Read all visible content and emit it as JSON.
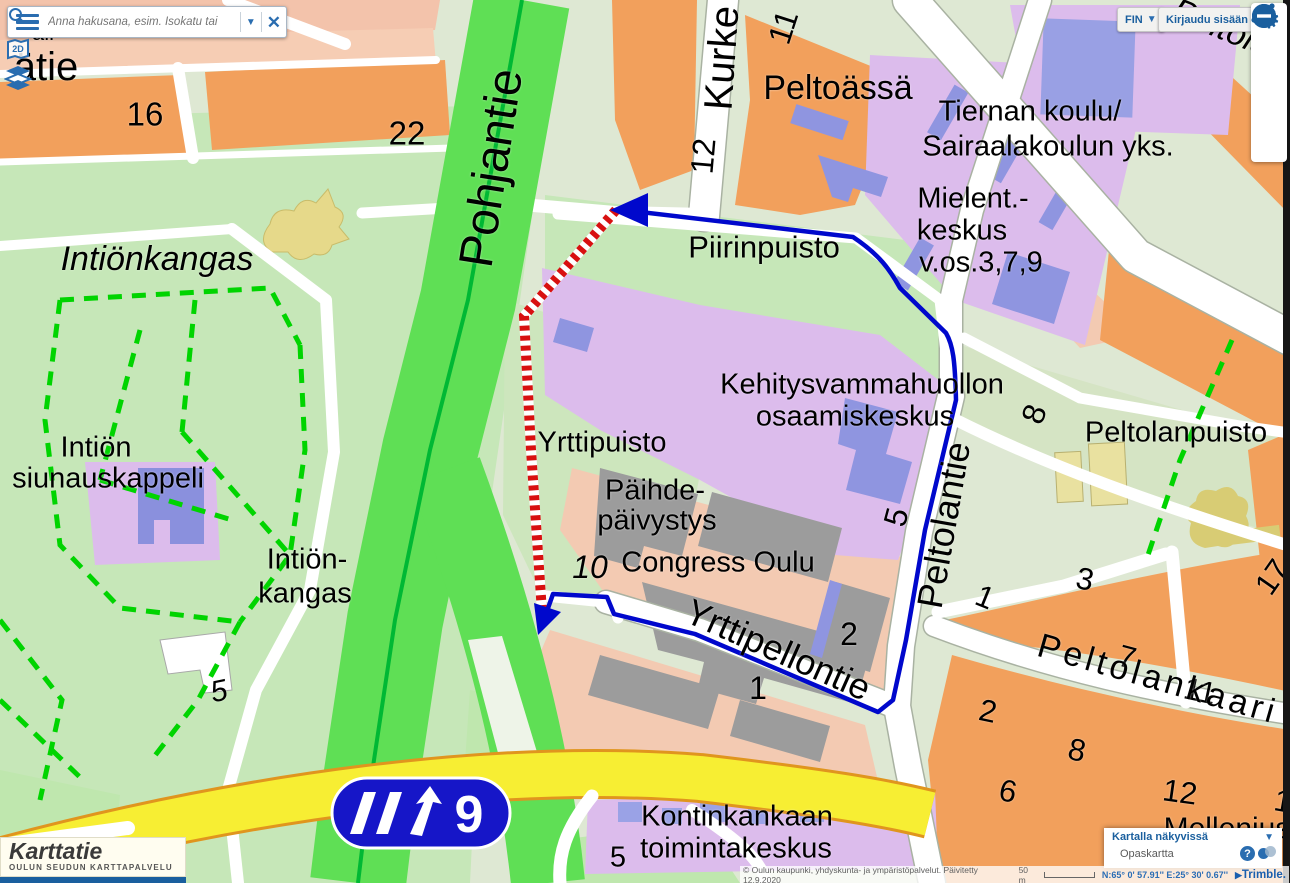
{
  "search": {
    "placeholder": "Anna hakusana, esim. Isokatu tai",
    "close_glyph": "✕",
    "caret_glyph": "▼"
  },
  "top_buttons": {
    "language": "FIN",
    "language_caret": "▼",
    "login": "Kirjaudu sisään"
  },
  "toolbar": {
    "tools": [
      "settings",
      "measure-route",
      "locate",
      "zoom-in",
      "zoom-out"
    ],
    "gear_glyph": "⚙",
    "zoom_in_glyph": "+",
    "zoom_out_glyph": "−"
  },
  "side_icons": {
    "map_2d_label": "2D"
  },
  "layers_panel": {
    "title": "Kartalla näkyvissä",
    "caret_glyph": "▼",
    "layer_name": "Opaskartta",
    "help_glyph": "?"
  },
  "statusbar": {
    "attribution": "© Oulun kaupunki, yhdyskunta- ja ympäristöpalvelut. Päivitetty 12.9.2020",
    "scale": "50 m",
    "coordinates": "N:65° 0' 57.91'' E:25° 30' 0.67''",
    "brand_triangle": "▶",
    "brand": "Trimble."
  },
  "logo": {
    "title": "Karttatie",
    "subtitle": "OULUN SEUDUN KARTTAPALVELU"
  },
  "highway_sign": {
    "number": "9"
  },
  "colors": {
    "route_blue": "#0008cc",
    "highway_green": "#5fdf55",
    "road_yellow": "#f7ee33",
    "area_orange": "#f2a05c",
    "area_purple": "#dcbcec",
    "area_pink": "#f6cdb4",
    "park_green": "#c6e7b8",
    "building_blue": "#8f95e0",
    "building_gray": "#9c9c9c",
    "path_dashed_green": "#00d400",
    "railway_red": "#d81010",
    "ui_blue": "#1a5f9e",
    "sign_blue": "#1616c8"
  },
  "map": {
    "labels": [
      {
        "t": "Pohjantie",
        "x": 492,
        "y": 168,
        "s": 48,
        "r": -81
      },
      {
        "t": "Kurke",
        "x": 722,
        "y": 58,
        "s": 40,
        "r": -86
      },
      {
        "t": "11",
        "x": 783,
        "y": 27,
        "s": 32,
        "r": -72
      },
      {
        "t": "12",
        "x": 703,
        "y": 156,
        "s": 32,
        "r": -85
      },
      {
        "t": "Peltoässä",
        "x": 838,
        "y": 88,
        "s": 34,
        "r": 0
      },
      {
        "t": "Tiernan koulu/",
        "x": 1030,
        "y": 112,
        "s": 29,
        "r": 0
      },
      {
        "t": "Sairaalakoulun yks.",
        "x": 1048,
        "y": 147,
        "s": 29,
        "r": 0
      },
      {
        "t": "Mielent.-",
        "x": 973,
        "y": 199,
        "s": 29,
        "r": 0
      },
      {
        "t": "keskus",
        "x": 962,
        "y": 231,
        "s": 29,
        "r": 0
      },
      {
        "t": "v.os.3,7,9",
        "x": 981,
        "y": 263,
        "s": 29,
        "r": 0
      },
      {
        "t": "Piirinpuisto",
        "x": 764,
        "y": 247,
        "s": 31,
        "r": 0
      },
      {
        "t": "Kehitysvammahuollon",
        "x": 862,
        "y": 385,
        "s": 29,
        "r": 0
      },
      {
        "t": "osaamiskeskus",
        "x": 855,
        "y": 417,
        "s": 29,
        "r": 0
      },
      {
        "t": "Yrttipuisto",
        "x": 602,
        "y": 443,
        "s": 29,
        "r": 0
      },
      {
        "t": "Päihde-",
        "x": 655,
        "y": 491,
        "s": 29,
        "r": 0
      },
      {
        "t": "päivystys",
        "x": 657,
        "y": 521,
        "s": 29,
        "r": 0
      },
      {
        "t": "10",
        "x": 590,
        "y": 567,
        "s": 32,
        "r": 0,
        "i": 1
      },
      {
        "t": "Congress Oulu",
        "x": 718,
        "y": 563,
        "s": 29,
        "r": 0
      },
      {
        "t": "Yrttipellontie",
        "x": 778,
        "y": 650,
        "s": 36,
        "r": 24
      },
      {
        "t": "Peltolantie",
        "x": 944,
        "y": 525,
        "s": 36,
        "r": -80
      },
      {
        "t": "5",
        "x": 896,
        "y": 517,
        "s": 32,
        "r": -75
      },
      {
        "t": "8",
        "x": 1034,
        "y": 414,
        "s": 32,
        "r": -70
      },
      {
        "t": "Peltolanpuisto",
        "x": 1176,
        "y": 433,
        "s": 29,
        "r": 0
      },
      {
        "t": "Intiönkangas",
        "x": 157,
        "y": 259,
        "s": 34,
        "r": 0,
        "i": 1
      },
      {
        "t": "Intiön",
        "x": 96,
        "y": 448,
        "s": 29,
        "r": 0
      },
      {
        "t": "siunauskappeli",
        "x": 108,
        "y": 479,
        "s": 29,
        "r": 0
      },
      {
        "t": "Intiön-",
        "x": 307,
        "y": 560,
        "s": 29,
        "r": 0
      },
      {
        "t": "kangas",
        "x": 305,
        "y": 594,
        "s": 29,
        "r": 0
      },
      {
        "t": "Kontinkankaan",
        "x": 737,
        "y": 817,
        "s": 29,
        "r": 0
      },
      {
        "t": "toimintakeskus",
        "x": 736,
        "y": 849,
        "s": 29,
        "r": 0
      },
      {
        "t": "5",
        "x": 618,
        "y": 858,
        "s": 29,
        "r": 0
      },
      {
        "t": "16",
        "x": 145,
        "y": 114,
        "s": 33,
        "r": 0
      },
      {
        "t": "22",
        "x": 407,
        "y": 133,
        "s": 33,
        "r": 0
      },
      {
        "t": "5",
        "x": 219,
        "y": 692,
        "s": 30,
        "r": -12,
        "i": 1
      },
      {
        "t": "2",
        "x": 849,
        "y": 634,
        "s": 32,
        "r": 0
      },
      {
        "t": "1",
        "x": 758,
        "y": 688,
        "s": 32,
        "r": 0
      },
      {
        "t": "1",
        "x": 985,
        "y": 597,
        "s": 31,
        "r": 22
      },
      {
        "t": "3",
        "x": 1085,
        "y": 579,
        "s": 31,
        "r": 12
      },
      {
        "t": "17",
        "x": 1272,
        "y": 577,
        "s": 31,
        "r": -55
      },
      {
        "t": "7",
        "x": 1127,
        "y": 657,
        "s": 31,
        "r": 15
      },
      {
        "t": "11",
        "x": 1200,
        "y": 691,
        "s": 31,
        "r": 12
      },
      {
        "t": "2",
        "x": 988,
        "y": 711,
        "s": 31,
        "r": 12
      },
      {
        "t": "8",
        "x": 1077,
        "y": 750,
        "s": 31,
        "r": 12
      },
      {
        "t": "6",
        "x": 1008,
        "y": 791,
        "s": 31,
        "r": 12
      },
      {
        "t": "12",
        "x": 1180,
        "y": 792,
        "s": 31,
        "r": 8
      },
      {
        "t": "1",
        "x": 1283,
        "y": 801,
        "s": 31,
        "r": 10
      },
      {
        "t": "Mellenius",
        "x": 1227,
        "y": 829,
        "s": 30,
        "r": 0
      },
      {
        "t": "Peltolankaari",
        "x": 1158,
        "y": 679,
        "s": 34,
        "r": 16,
        "ls": 4
      },
      {
        "t": "ätie",
        "x": 46,
        "y": 67,
        "s": 40,
        "r": 0
      },
      {
        "t": "ali",
        "x": 43,
        "y": 33,
        "s": 22,
        "r": 0
      },
      {
        "t": "Peltola",
        "x": 1222,
        "y": 28,
        "s": 34,
        "r": 22,
        "i": 1
      }
    ]
  }
}
